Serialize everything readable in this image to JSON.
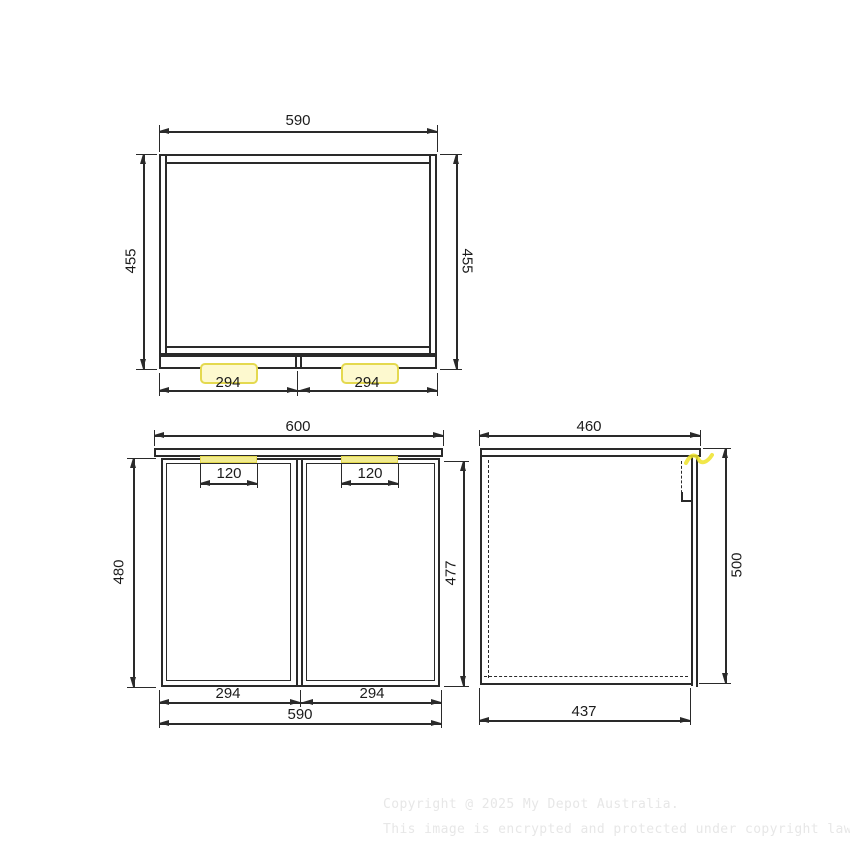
{
  "drawing": {
    "type": "cabinet-technical-drawing",
    "views": [
      "top-plan-view",
      "front-view",
      "side-view"
    ]
  },
  "colors": {
    "line": "#2a2a2a",
    "dim_text": "#1c1c1c",
    "highlight_border": "#e4d94f",
    "highlight_fill": "#fdf9cf",
    "highlight_strip": "#f1eb8e",
    "highlight_mark": "#efe32a",
    "watermark": "#e7e7e7"
  },
  "dims": {
    "top_view": {
      "width": "590",
      "depth_left": "455",
      "depth_right": "455",
      "door_left": "294",
      "door_right": "294"
    },
    "front_view": {
      "countertop_width": "600",
      "handle_left": "120",
      "handle_right": "120",
      "height_left": "480",
      "door_height": "477",
      "door_left": "294",
      "door_right": "294",
      "body_width": "590"
    },
    "side_view": {
      "depth": "460",
      "height": "500",
      "internal_depth": "437"
    }
  },
  "watermark": {
    "line1": "Copyright @ 2025 My Depot Australia.",
    "line2": "This image is encrypted and protected under copyright law."
  }
}
